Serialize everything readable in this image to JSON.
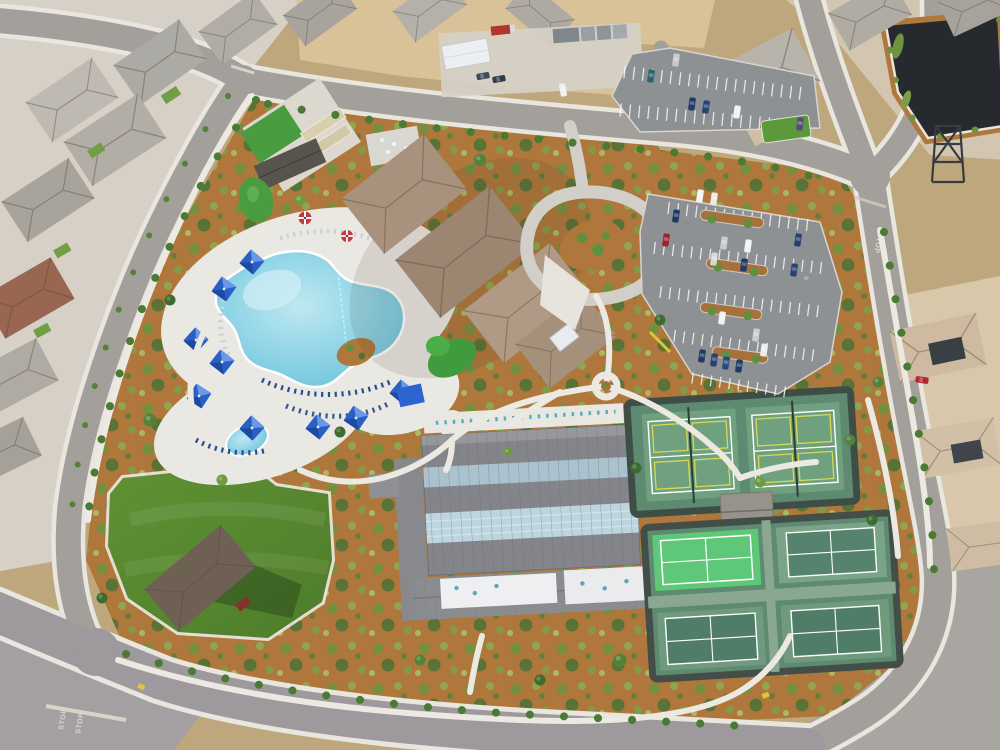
{
  "scene": {
    "setting": "aerial-view-community-recreation-center",
    "time_of_day": "day"
  },
  "road_markings": {
    "stop_label": "STOP",
    "painted_stop_count": 3
  },
  "amenities": {
    "pool": {
      "name": "resort-style-pool",
      "cabanas": 9,
      "spa": 1,
      "umbrellas": 2
    },
    "clubhouse": {
      "name": "clubhouse",
      "roof_wings": 4,
      "skylights": 1
    },
    "sports_hall": {
      "name": "indoor-sports-building",
      "skylight_bands": 2
    },
    "tennis_courts": {
      "count": 2
    },
    "pickleball_courts": {
      "count": 4,
      "bright_courts": 1
    },
    "event_lawn": {
      "name": "event-lawn",
      "stage_pavilion": 1
    },
    "bocce_courts": {
      "count": 2
    },
    "putting_greens": {
      "count": 3
    },
    "parking": {
      "lots": 2,
      "visible_cars": 28
    },
    "pond": {
      "name": "dark-pond"
    },
    "construction": {
      "dirt_lot": 1,
      "trailers": 1,
      "containers": 4
    }
  },
  "palette": {
    "pool_water": "#8fd4e6",
    "cabana_blue": "#2a5fc4",
    "mulch": "#b0773c",
    "lawn_green": "#57862e",
    "court_green": "#6fa17f",
    "pickleball_bright": "#5ec878",
    "roof_tan": "#a8917d",
    "sports_roof_gray": "#84858a",
    "asphalt": "#a3a09c",
    "sidewalk": "#eae8e2",
    "dirt": "#d9c297",
    "pond_dark": "#26292e"
  }
}
